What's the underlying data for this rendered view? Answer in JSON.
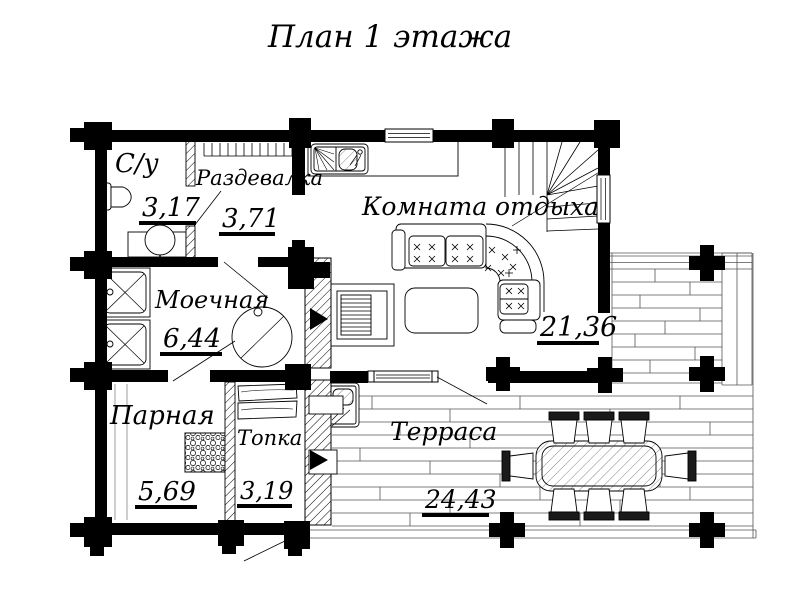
{
  "title": "План 1 этажа",
  "rooms": [
    {
      "name": "С/у",
      "area": "3,17"
    },
    {
      "name": "Раздевалка",
      "area": "3,71"
    },
    {
      "name": "Комната отдыха",
      "area": "21,36"
    },
    {
      "name": "Моечная",
      "area": "6,44"
    },
    {
      "name": "Парная",
      "area": "5,69"
    },
    {
      "name": "Топка",
      "area": "3,19"
    },
    {
      "name": "Терраса",
      "area": "24,43"
    }
  ],
  "colors": {
    "walls": "#000000",
    "paper": "#ffffff",
    "thin_lines": "#1a1a1a"
  }
}
